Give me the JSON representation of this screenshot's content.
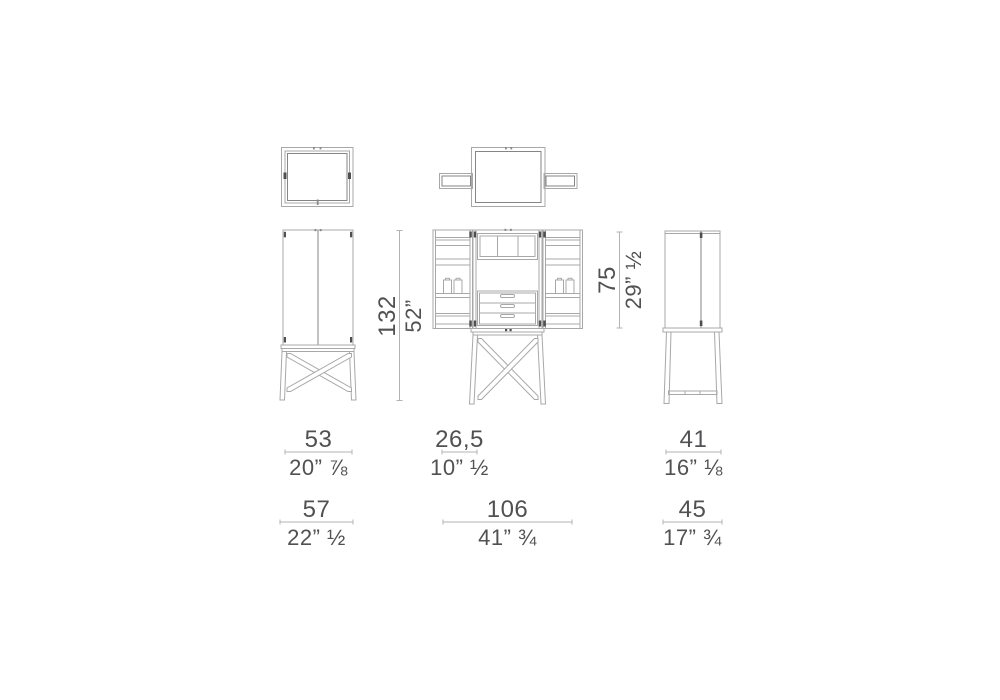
{
  "palette": {
    "background": "#ffffff",
    "outline_light": "#a8a8a8",
    "outline_mid": "#858585",
    "hinge_mark": "#4f4f4f",
    "dimension_line": "#b3b3b3",
    "dimension_text": "#515153"
  },
  "dimensions": {
    "height_closed": {
      "cm": "132",
      "in": "52”"
    },
    "height_open": {
      "cm": "75",
      "in": "29” ½"
    },
    "width_cabinet": {
      "cm": "53",
      "in": "20” ⅞"
    },
    "depth_tray": {
      "cm": "26,5",
      "in": "10” ½"
    },
    "depth_cabinet": {
      "cm": "41",
      "in": "16” ⅛"
    },
    "width_base": {
      "cm": "57",
      "in": "22” ½"
    },
    "width_open": {
      "cm": "106",
      "in": "41” ¾"
    },
    "depth_base": {
      "cm": "45",
      "in": "17” ¾"
    }
  }
}
